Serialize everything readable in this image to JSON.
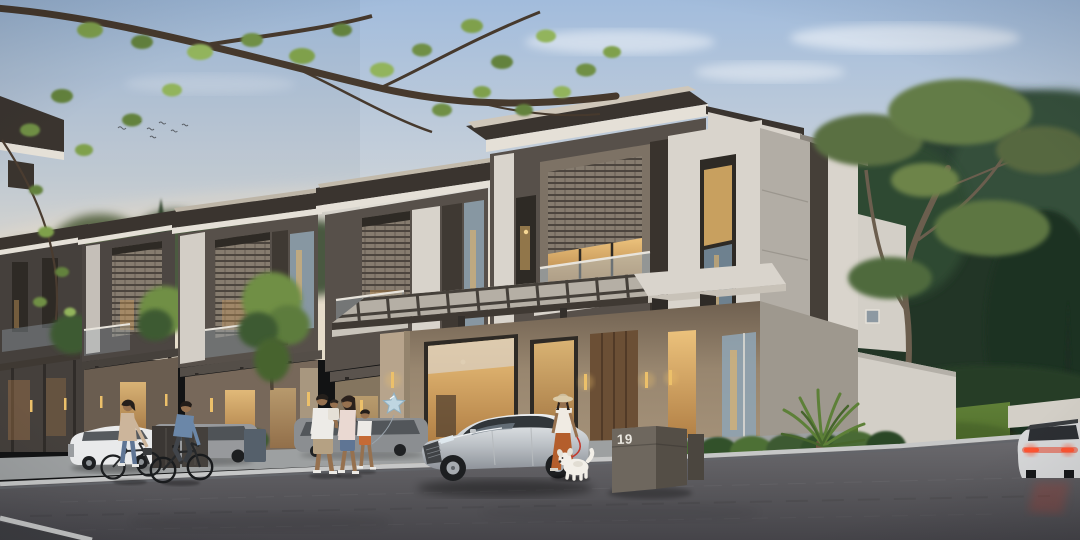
{
  "scene": {
    "alt": "Dusk architectural rendering of a modern two-storey townhouse row with residents cycling, a family walking with a star balloon, a woman walking a white dog, a silver sedan parked in the driveway and a mailbox numbered 19",
    "mailbox": {
      "number": "19"
    },
    "palette": {
      "sky_top": "#a2bcdc",
      "sky_mid": "#c9d1d9",
      "sky_horizon": "#efe5d3",
      "roof_dark": "#3a342f",
      "fascia_white": "#e5e0d7",
      "wall_white": "#d9d4cc",
      "wall_gray": "#b5b0a8",
      "wall_dark": "#57504a",
      "accent_brown": "#3f3933",
      "wood_warm": "#9b8870",
      "pillar_beige": "#b7a48c",
      "window_warm": "#dca75f",
      "window_frame": "#2e2a25",
      "glass_cool": "#8fa3b1",
      "lattice": "#867c6f",
      "foliage": "#6f8f45",
      "foliage_dark": "#3e5a33",
      "pine": "#32452f",
      "forest_deep": "#2a4030",
      "lawn": "#587733",
      "road": "#5d5d61",
      "curb": "#c6c7c7",
      "sidewalk": "#9da0a1",
      "car_silver": "#ccd0d4",
      "car_white": "#e9eaeb",
      "car_gray": "#97999c",
      "taillight": "#e8472b",
      "sconce_gold": "#ecc06a",
      "skin": "#96714f",
      "shirt_blue": "#6b87a8",
      "jacket_beige": "#ccb59b",
      "denim": "#5f7594",
      "pants_rust": "#b45e2c",
      "hat_beige": "#dbcba9",
      "dog_white": "#f2efe8",
      "balloon_blue": "#bfd6e1",
      "leash_red": "#c23a2e",
      "mailbox_front": "#6e675e",
      "mailbox_side": "#544e46",
      "mailbox_text": "#eae7e0"
    }
  }
}
